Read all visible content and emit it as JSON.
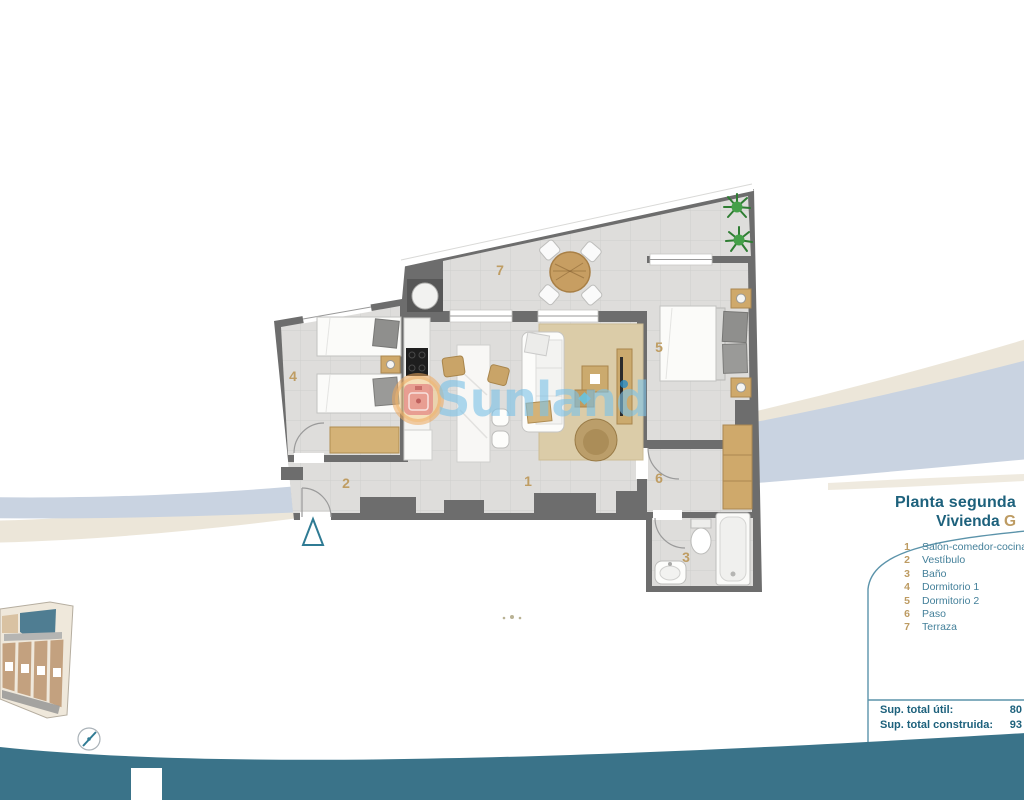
{
  "header": {
    "floor_title": "Planta segunda",
    "unit_prefix": "Vivienda",
    "unit_letter": "G"
  },
  "legend": {
    "items": [
      {
        "number": "1",
        "label": "Salón-comedor-cocina"
      },
      {
        "number": "2",
        "label": "Vestíbulo"
      },
      {
        "number": "3",
        "label": "Baño"
      },
      {
        "number": "4",
        "label": "Dormitorio 1"
      },
      {
        "number": "5",
        "label": "Dormitorio 2"
      },
      {
        "number": "6",
        "label": "Paso"
      },
      {
        "number": "7",
        "label": "Terraza"
      }
    ]
  },
  "totals": {
    "rows": [
      {
        "label": "Sup. total útil:",
        "value": "80"
      },
      {
        "label": "Sup. total construida:",
        "value": "93"
      }
    ]
  },
  "watermark": {
    "text": "Sunland"
  },
  "colors": {
    "accent_teal": "#1d617c",
    "legend_teal": "#44809a",
    "accent_tan": "#bd9b62",
    "footer_band": "#3a7389",
    "wall_gray": "#6d6d6d",
    "swoosh_blue": "#c9d3e1",
    "swoosh_beige": "#ece6d9",
    "keyplan_unit_teal": "#4f7d92"
  }
}
